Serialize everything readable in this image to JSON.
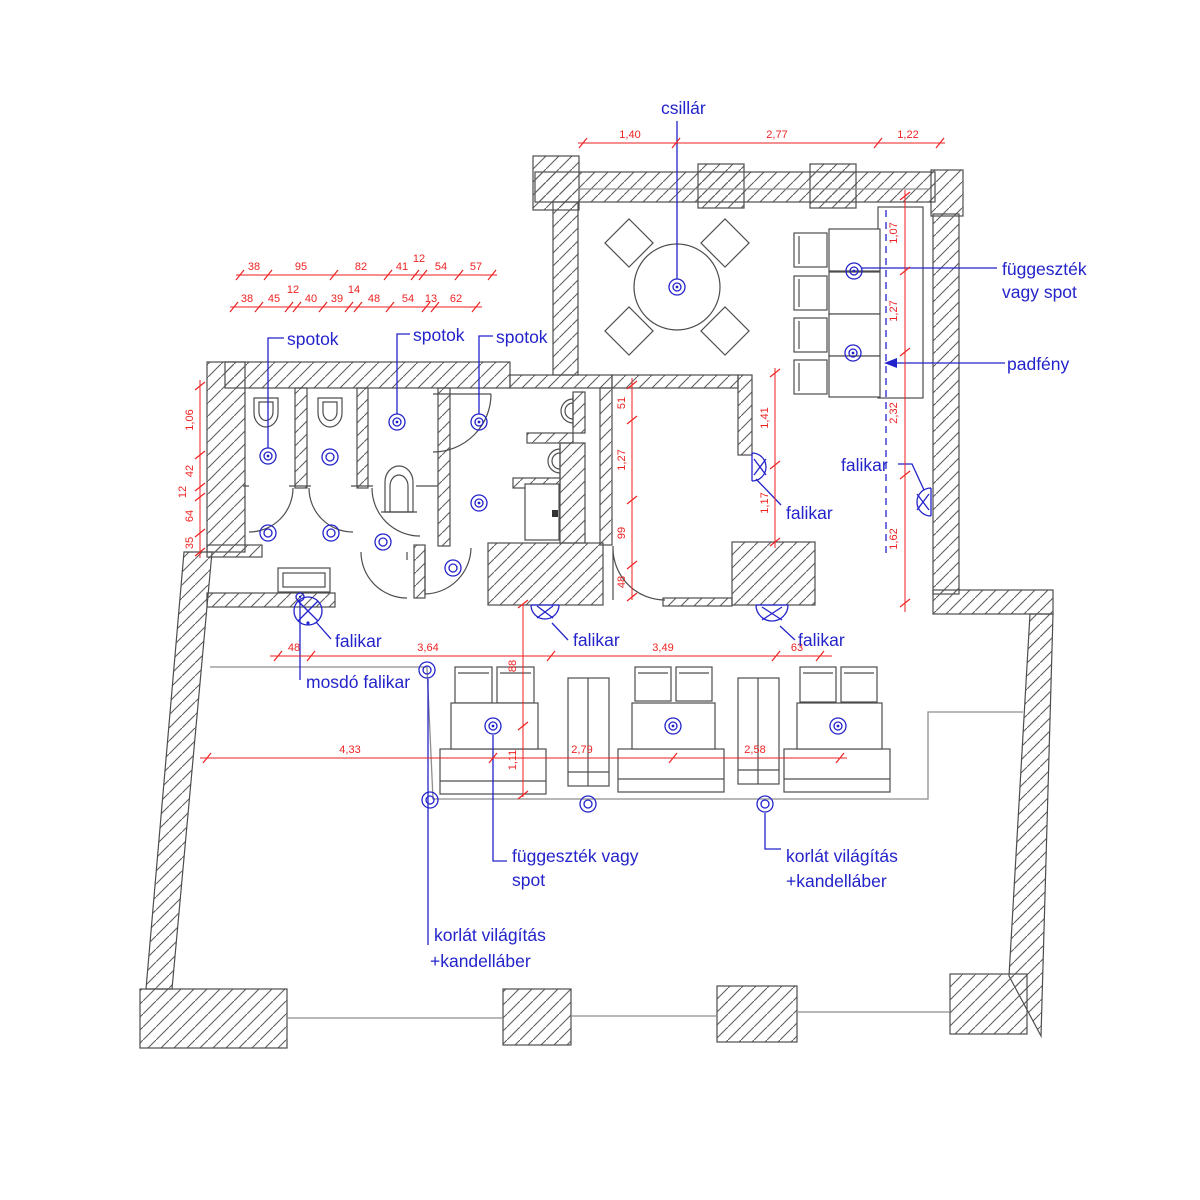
{
  "drawing": {
    "type": "lighting-floor-plan",
    "language": "hu"
  },
  "colors": {
    "label_blue": "#2323cb",
    "dimension_red": "#ee2222",
    "wall_line": "#4d4d4d",
    "railing_gray": "#8e8e8e",
    "background": "#ffffff"
  },
  "labels": {
    "csillar": "csillár",
    "spotok_1": "spotok",
    "spotok_2": "spotok",
    "spotok_3": "spotok",
    "fuggesztek_right_line1": "függeszték",
    "fuggesztek_right_line2": "vagy spot",
    "padfeny": "padfény",
    "falikar_right_wall": "falikar",
    "falikar_mid_room": "falikar",
    "falikar_bottom_1": "falikar",
    "falikar_bottom_2": "falikar",
    "falikar_bottom_3": "falikar",
    "mosdo_falikar": "mosdó falikar",
    "fuggesztek_bottom_line1": "függeszték vagy",
    "fuggesztek_bottom_line2": "spot",
    "korlat_1_line1": "korlát világítás",
    "korlat_1_line2": "+kandelláber",
    "korlat_2_line1": "korlát világítás",
    "korlat_2_line2": "+kandelláber"
  },
  "dimensions": {
    "top": [
      "1,40",
      "2,77",
      "1,22"
    ],
    "upper_row1": [
      "38",
      "95",
      "82",
      "41",
      "12",
      "54",
      "57"
    ],
    "upper_row2": [
      "38",
      "45",
      "12",
      "40",
      "39",
      "14",
      "48",
      "54",
      "13",
      "62"
    ],
    "left_v": [
      "1,06",
      "42",
      "12",
      "64",
      "35"
    ],
    "right_v": [
      "1,07",
      "1,27",
      "2,32",
      "1,62"
    ],
    "mid_room_v": [
      "51",
      "1,27",
      "99",
      "48"
    ],
    "mid_right_v": [
      "1,41",
      "1,17"
    ],
    "bottom_row1": [
      "48",
      "3,64",
      "3,49",
      "63"
    ],
    "bottom_row2": [
      "4,33",
      "2,79",
      "2,58"
    ],
    "stairs_v": [
      "88",
      "1,11"
    ]
  },
  "symbols": {
    "pendant_or_spot": "double-circle",
    "wall_lamp": "half-circle-with-cross",
    "ceiling_line": "blue-dashed-line"
  }
}
